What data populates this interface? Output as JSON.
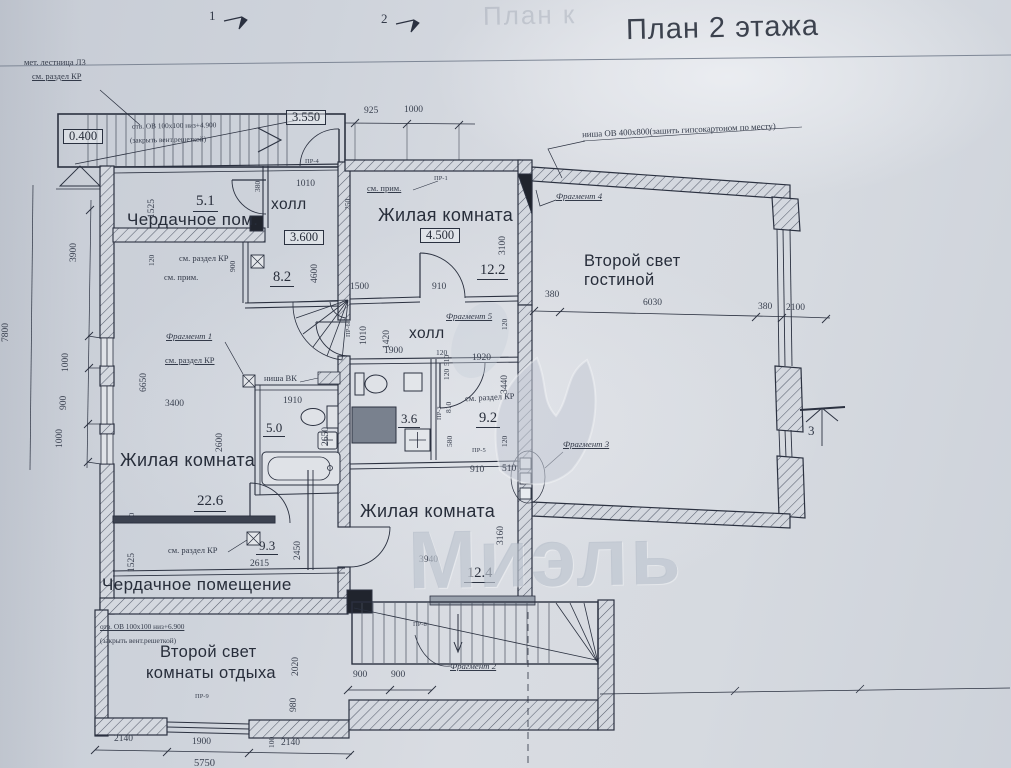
{
  "sheet": {
    "title": "План 2 этажа",
    "ghost_text": "План к",
    "axis_marks": {
      "a1": "1",
      "a2": "2"
    },
    "section_marker": "3"
  },
  "watermark": {
    "text": "Миэль"
  },
  "elevations": {
    "e1": "0.400",
    "e2": "3.550",
    "e3": "3.600",
    "e4": "4.500"
  },
  "rooms": {
    "attic_top": {
      "area": "5.1",
      "name": "Чердачное пом."
    },
    "hall_top": {
      "name": "холл",
      "area": "8.2"
    },
    "living_top": {
      "name": "Жилая комната",
      "area": "12.2"
    },
    "second_light_living": {
      "line1": "Второй свет",
      "line2": "гостиной"
    },
    "hall_mid": {
      "name": "холл"
    },
    "bath_small": {
      "area": "3.6"
    },
    "room_92": {
      "area": "9.2"
    },
    "bath_50": {
      "area": "5.0"
    },
    "living_left": {
      "name": "Жилая комната",
      "area": "22.6"
    },
    "room_93": {
      "area": "9.3"
    },
    "attic_bottom": {
      "name": "Чердачное помещение"
    },
    "living_bottom": {
      "name": "Жилая комната",
      "area": "12.4"
    },
    "second_light_rest": {
      "line1": "Второй свет",
      "line2": "комнаты отдыха"
    }
  },
  "notes": {
    "stair_note1": "мет. лестница Л3",
    "stair_note2": "см. раздел КР",
    "vent_top1": "отв. ОВ 100х100 низ+4.900",
    "vent_top2": "(закрыть вент.решеткой)",
    "niche_ov": "ниша ОВ 400х800(зашить гипсокартоном по месту)",
    "niche_vk": "ниша ВК",
    "see_kr": "см. раздел КР",
    "see_prim": "см. прим.",
    "vent_bottom1": "отв. ОВ 100х100 низ+6.900",
    "vent_bottom2": "(закрыть вент.решеткой)"
  },
  "fragments": {
    "f1": "Фрагмент 1",
    "f2": "Фрагмент 2",
    "f3": "Фрагмент 3",
    "f4": "Фрагмент 4",
    "f5": "Фрагмент 5"
  },
  "door_tags": {
    "pr1": "ПР-1",
    "pr3": "ПР-3",
    "pr4": "ПР-4",
    "pr5": "ПР-5",
    "pr6": "ПР-6",
    "pr8": "ПР-8",
    "pr9": "ПР-9"
  },
  "dims": {
    "d925": "925",
    "d1000t": "1000",
    "d3900": "3900",
    "d7800": "7800",
    "d1000a": "1000",
    "d900a": "900",
    "d1000b": "1000",
    "d1525a": "1525",
    "d120a": "120",
    "d380a": "380",
    "d1010a": "1010",
    "d250": "250",
    "d900b": "900",
    "d4600": "4600",
    "d1500": "1500",
    "d910a": "910",
    "d3100": "3100",
    "d380b": "380",
    "d6030": "6030",
    "d380c": "380",
    "d2100": "2100",
    "d6650": "6650",
    "d3400": "3400",
    "d2600": "2600",
    "d1910": "1910",
    "d2650": "2650",
    "d1010b": "1010",
    "d1420": "1420",
    "d1900a": "1900",
    "d120b": "120",
    "d1920": "1920",
    "d3440": "3440",
    "d510a": "510",
    "d120c": "120",
    "d810": "810",
    "d580": "580",
    "d120d": "120",
    "d120e": "120",
    "d910b": "910",
    "d510b": "510",
    "d120f": "120",
    "d1525b": "1525",
    "d2450": "2450",
    "d2615": "2615",
    "d3940": "3940",
    "d3160": "3160",
    "d2020": "2020",
    "d980": "980",
    "d900c": "900",
    "d900d": "900",
    "d2140a": "2140",
    "d1900b": "1900",
    "d100": "100",
    "d2140b": "2140",
    "d5750": "5750"
  }
}
